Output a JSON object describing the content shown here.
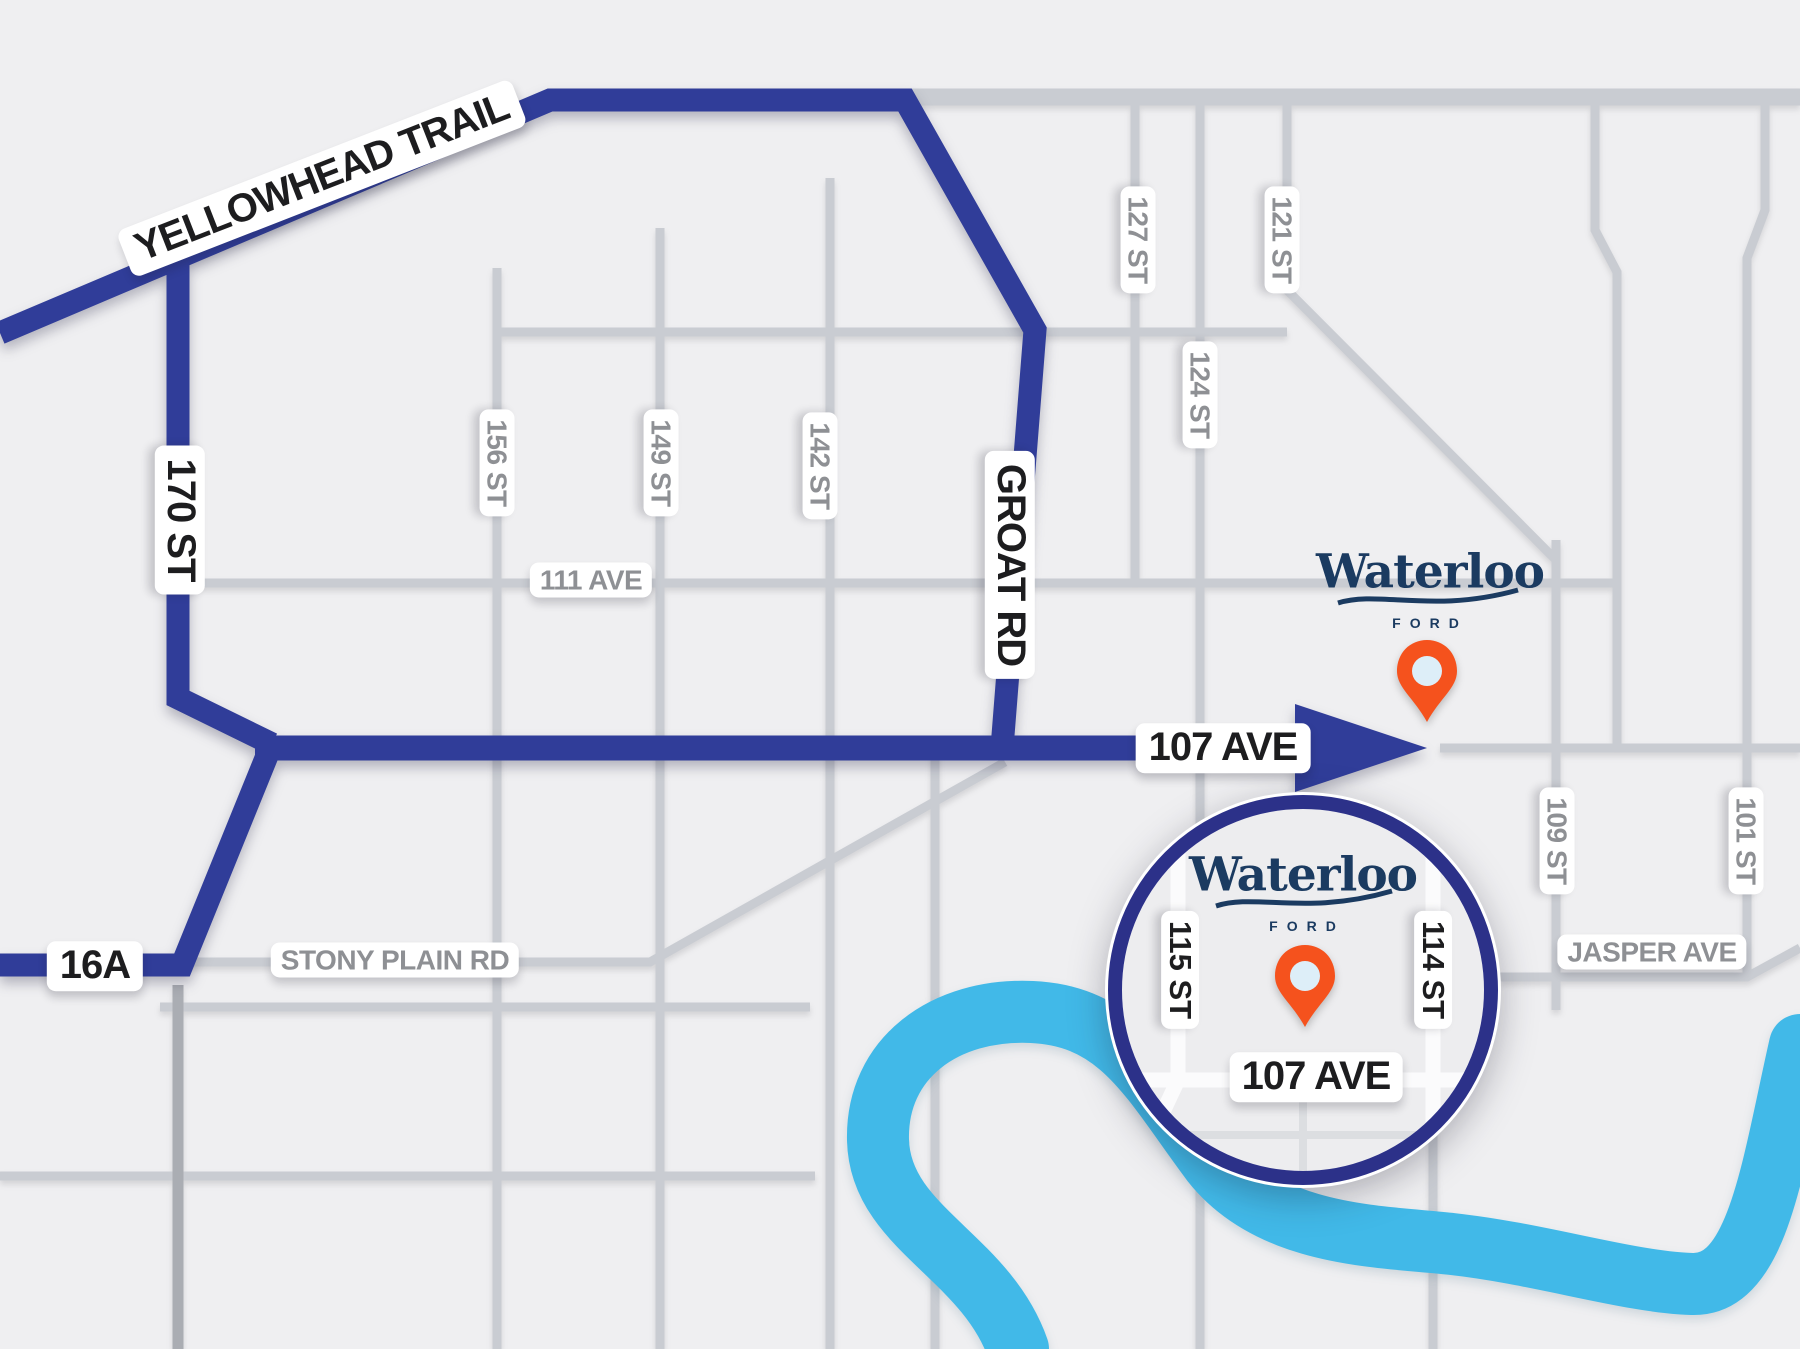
{
  "route": {
    "yellowhead": "YELLOWHEAD TRAIL",
    "st_170": "170 ST",
    "groat_rd": "GROAT RD",
    "ave_107": "107 AVE",
    "hwy_16a": "16A"
  },
  "streets": {
    "st_156": "156 ST",
    "st_149": "149 ST",
    "st_142": "142 ST",
    "st_127": "127 ST",
    "st_124": "124 ST",
    "st_121": "121 ST",
    "st_109": "109 ST",
    "st_101": "101 ST",
    "ave_111": "111 AVE",
    "stony_plain": "STONY PLAIN RD",
    "jasper": "JASPER AVE"
  },
  "inset": {
    "st_115": "115 ST",
    "st_114": "114 ST",
    "ave_107": "107 AVE"
  },
  "dealership": {
    "name": "Waterloo",
    "brand": "FORD"
  },
  "colors": {
    "background": "#efeff1",
    "route_navy": "#303D99",
    "inset_ring_navy": "#2C3189",
    "logo_navy": "#1b3b61",
    "pin_orange": "#F5521D",
    "pin_hole": "#ddeef8",
    "river_blue": "#41B9E8",
    "minor_road_gray": "#c9ccd2",
    "minor_label_gray": "#8e9094",
    "label_black": "#1d1d1f"
  }
}
